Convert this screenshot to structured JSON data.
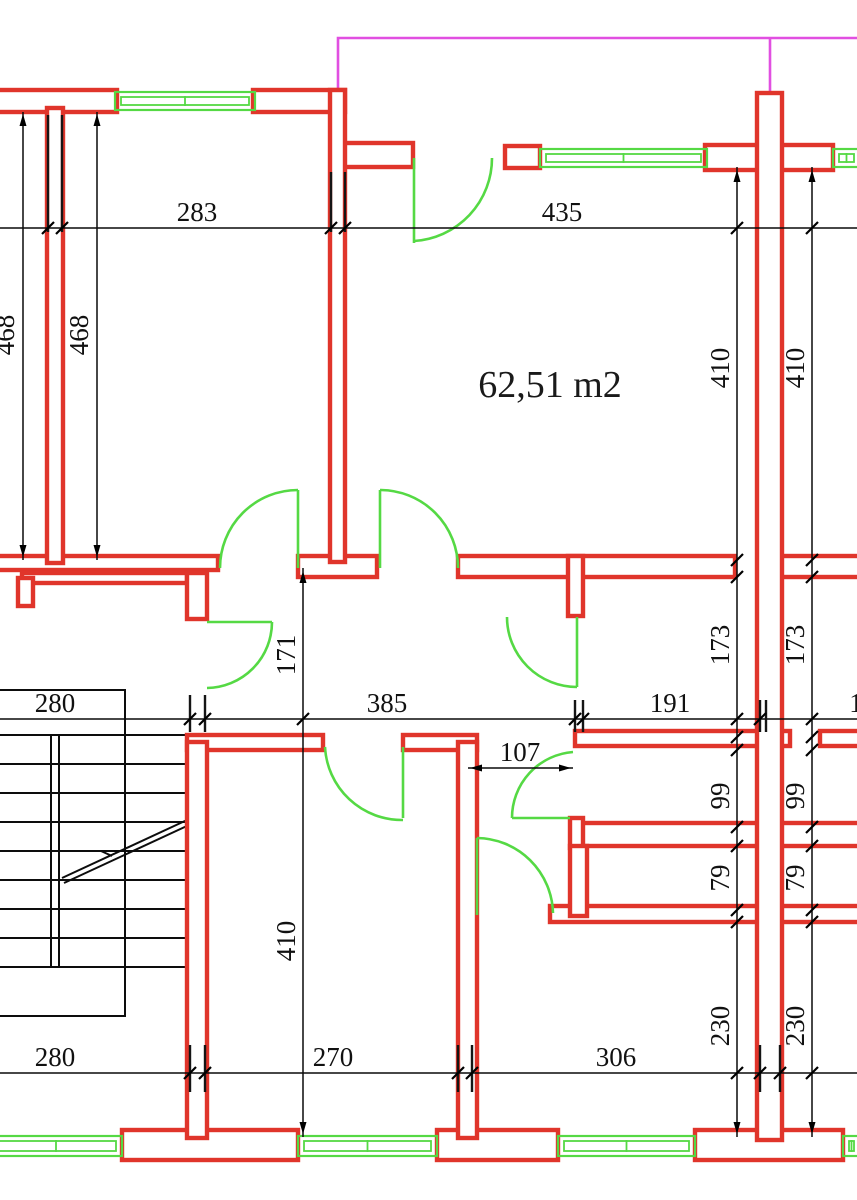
{
  "labels": {
    "area": "62,51 m2"
  },
  "colors": {
    "wall": "#e0352b",
    "opening": "#55d944",
    "reference": "#e14fe1",
    "dimension": "#0a0a0a",
    "background": "#ffffff"
  },
  "dimensions": [
    {
      "text": "283",
      "x": 197,
      "y": 221,
      "rot": 0
    },
    {
      "text": "435",
      "x": 562,
      "y": 221,
      "rot": 0
    },
    {
      "text": "468",
      "x": 14,
      "y": 335,
      "rot": -90
    },
    {
      "text": "468",
      "x": 88,
      "y": 335,
      "rot": -90
    },
    {
      "text": "410",
      "x": 729,
      "y": 368,
      "rot": -90
    },
    {
      "text": "410",
      "x": 804,
      "y": 368,
      "rot": -90
    },
    {
      "text": "171",
      "x": 295,
      "y": 655,
      "rot": -90
    },
    {
      "text": "173",
      "x": 729,
      "y": 645,
      "rot": -90
    },
    {
      "text": "173",
      "x": 804,
      "y": 645,
      "rot": -90
    },
    {
      "text": "280",
      "x": 55,
      "y": 712,
      "rot": 0
    },
    {
      "text": "385",
      "x": 387,
      "y": 712,
      "rot": 0
    },
    {
      "text": "191",
      "x": 670,
      "y": 712,
      "rot": 0
    },
    {
      "text": "1",
      "x": 856,
      "y": 712,
      "rot": 0
    },
    {
      "text": "107",
      "x": 520,
      "y": 761,
      "rot": 0
    },
    {
      "text": "99",
      "x": 729,
      "y": 796,
      "rot": -90
    },
    {
      "text": "99",
      "x": 804,
      "y": 796,
      "rot": -90
    },
    {
      "text": "79",
      "x": 729,
      "y": 878,
      "rot": -90
    },
    {
      "text": "79",
      "x": 804,
      "y": 878,
      "rot": -90
    },
    {
      "text": "410",
      "x": 295,
      "y": 941,
      "rot": -90
    },
    {
      "text": "230",
      "x": 729,
      "y": 1026,
      "rot": -90
    },
    {
      "text": "230",
      "x": 804,
      "y": 1026,
      "rot": -90
    },
    {
      "text": "280",
      "x": 55,
      "y": 1066,
      "rot": 0
    },
    {
      "text": "270",
      "x": 333,
      "y": 1066,
      "rot": 0
    },
    {
      "text": "306",
      "x": 616,
      "y": 1066,
      "rot": 0
    }
  ],
  "geometry": {
    "walls": [
      [
        -10,
        90,
        127,
        22
      ],
      [
        253,
        90,
        92,
        22
      ],
      [
        343,
        143,
        70,
        24
      ],
      [
        505,
        146,
        35,
        22
      ],
      [
        705,
        145,
        128,
        25
      ],
      [
        -10,
        556,
        228,
        14
      ],
      [
        22,
        573,
        165,
        10
      ],
      [
        298,
        556,
        79,
        21
      ],
      [
        458,
        556,
        277,
        21
      ],
      [
        780,
        556,
        80,
        21
      ],
      [
        187,
        735,
        136,
        15
      ],
      [
        403,
        735,
        74,
        15
      ],
      [
        575,
        731,
        215,
        15
      ],
      [
        820,
        731,
        40,
        15
      ],
      [
        578,
        823,
        282,
        23
      ],
      [
        550,
        906,
        310,
        16
      ],
      [
        122,
        1130,
        176,
        30
      ],
      [
        437,
        1130,
        121,
        30
      ],
      [
        695,
        1130,
        148,
        30
      ],
      [
        18,
        578,
        15,
        28
      ],
      [
        568,
        556,
        15,
        60
      ],
      [
        187,
        573,
        20,
        46
      ],
      [
        570,
        818,
        13,
        30
      ],
      [
        570,
        846,
        17,
        70
      ],
      [
        47,
        108,
        16,
        455
      ],
      [
        330,
        90,
        15,
        472
      ],
      [
        187,
        742,
        20,
        396
      ],
      [
        458,
        742,
        19,
        396
      ],
      [
        757,
        93,
        25,
        1047
      ]
    ],
    "windows": [
      [
        115,
        92,
        140,
        18
      ],
      [
        540,
        149,
        167,
        18
      ],
      [
        833,
        149,
        27,
        18
      ],
      [
        -10,
        1136,
        132,
        20
      ],
      [
        298,
        1136,
        139,
        20
      ],
      [
        558,
        1136,
        137,
        20
      ],
      [
        843,
        1136,
        17,
        20
      ]
    ],
    "door_leaves": [
      "M298 490 L298 568",
      "M380 490 L380 568",
      "M207 622 L272 622",
      "M403 747 L403 818",
      "M512 818 L570 818",
      "M477 838 L477 915",
      "M414 158 L414 243",
      "M577 617 L577 687"
    ],
    "door_arcs": [
      "M298 490 A78 78 0 0 0 220 568",
      "M380 490 A78 78 0 0 1 458 568",
      "M272 622 A66 66 0 0 1 207 688",
      "M325 747 A77 77 0 0 0 403 820",
      "M573 752 A66 66 0 0 0 512 818",
      "M477 838 A77 77 0 0 1 553 913",
      "M492 158 A83 83 0 0 1 414 241",
      "M507 617 A70 70 0 0 0 577 687"
    ],
    "dim_lines": [
      [
        0,
        228,
        857,
        228
      ],
      [
        0,
        719,
        857,
        719
      ],
      [
        468,
        768,
        573,
        768
      ],
      [
        0,
        1073,
        857,
        1073
      ],
      [
        23,
        112,
        23,
        560
      ],
      [
        97,
        112,
        97,
        560
      ],
      [
        737,
        167,
        737,
        1137
      ],
      [
        812,
        167,
        812,
        1137
      ],
      [
        303,
        568,
        303,
        1137
      ]
    ],
    "ext_lines": [
      [
        48,
        115,
        48,
        232
      ],
      [
        62,
        115,
        62,
        232
      ],
      [
        331,
        172,
        331,
        232
      ],
      [
        345,
        172,
        345,
        232
      ],
      [
        190,
        695,
        190,
        732
      ],
      [
        205,
        695,
        205,
        732
      ],
      [
        575,
        700,
        575,
        732
      ],
      [
        583,
        700,
        583,
        732
      ],
      [
        760,
        700,
        760,
        732
      ],
      [
        766,
        700,
        766,
        732
      ],
      [
        190,
        1045,
        190,
        1092
      ],
      [
        205,
        1045,
        205,
        1092
      ],
      [
        458,
        1045,
        458,
        1092
      ],
      [
        472,
        1045,
        472,
        1092
      ],
      [
        760,
        1045,
        760,
        1092
      ],
      [
        780,
        1045,
        780,
        1092
      ]
    ],
    "ticks": [
      [
        48,
        228
      ],
      [
        62,
        228
      ],
      [
        331,
        228
      ],
      [
        345,
        228
      ],
      [
        737,
        228
      ],
      [
        812,
        228
      ],
      [
        190,
        719
      ],
      [
        205,
        719
      ],
      [
        303,
        719
      ],
      [
        575,
        719
      ],
      [
        583,
        719
      ],
      [
        737,
        719
      ],
      [
        760,
        719
      ],
      [
        812,
        719
      ],
      [
        190,
        1073
      ],
      [
        205,
        1073
      ],
      [
        458,
        1073
      ],
      [
        472,
        1073
      ],
      [
        737,
        1073
      ],
      [
        760,
        1073
      ],
      [
        780,
        1073
      ],
      [
        812,
        1073
      ],
      [
        737,
        560
      ],
      [
        737,
        577
      ],
      [
        737,
        737
      ],
      [
        737,
        750
      ],
      [
        737,
        827
      ],
      [
        737,
        846
      ],
      [
        737,
        910
      ],
      [
        737,
        922
      ],
      [
        812,
        560
      ],
      [
        812,
        577
      ],
      [
        812,
        737
      ],
      [
        812,
        750
      ],
      [
        812,
        827
      ],
      [
        812,
        846
      ],
      [
        812,
        910
      ],
      [
        812,
        922
      ]
    ],
    "arrows": [
      {
        "x": 23,
        "y": 114,
        "dir": "up"
      },
      {
        "x": 97,
        "y": 114,
        "dir": "up"
      },
      {
        "x": 23,
        "y": 557,
        "dir": "down"
      },
      {
        "x": 97,
        "y": 557,
        "dir": "down"
      },
      {
        "x": 737,
        "y": 170,
        "dir": "up"
      },
      {
        "x": 812,
        "y": 170,
        "dir": "up"
      },
      {
        "x": 737,
        "y": 1134,
        "dir": "down"
      },
      {
        "x": 812,
        "y": 1134,
        "dir": "down"
      },
      {
        "x": 303,
        "y": 571,
        "dir": "up"
      },
      {
        "x": 303,
        "y": 1134,
        "dir": "down"
      },
      {
        "x": 470,
        "y": 768,
        "dir": "left"
      },
      {
        "x": 571,
        "y": 768,
        "dir": "right"
      }
    ],
    "stairs": {
      "outline": "M-6 690 L125 690 L125 1016 L-6 1016",
      "treads_y": [
        735,
        764,
        793,
        822,
        851,
        880,
        909,
        938,
        967
      ],
      "treads_x": [
        -6,
        187
      ],
      "divider_x": [
        51,
        59
      ],
      "divider_y": [
        735,
        967
      ],
      "diagonal": [
        "M62 878 L187 820",
        "M64 883 L189 825",
        "M112 856 L101 851"
      ]
    },
    "reference_path": "M338 93 L338 38 L860 38 M770 38 L770 93"
  }
}
